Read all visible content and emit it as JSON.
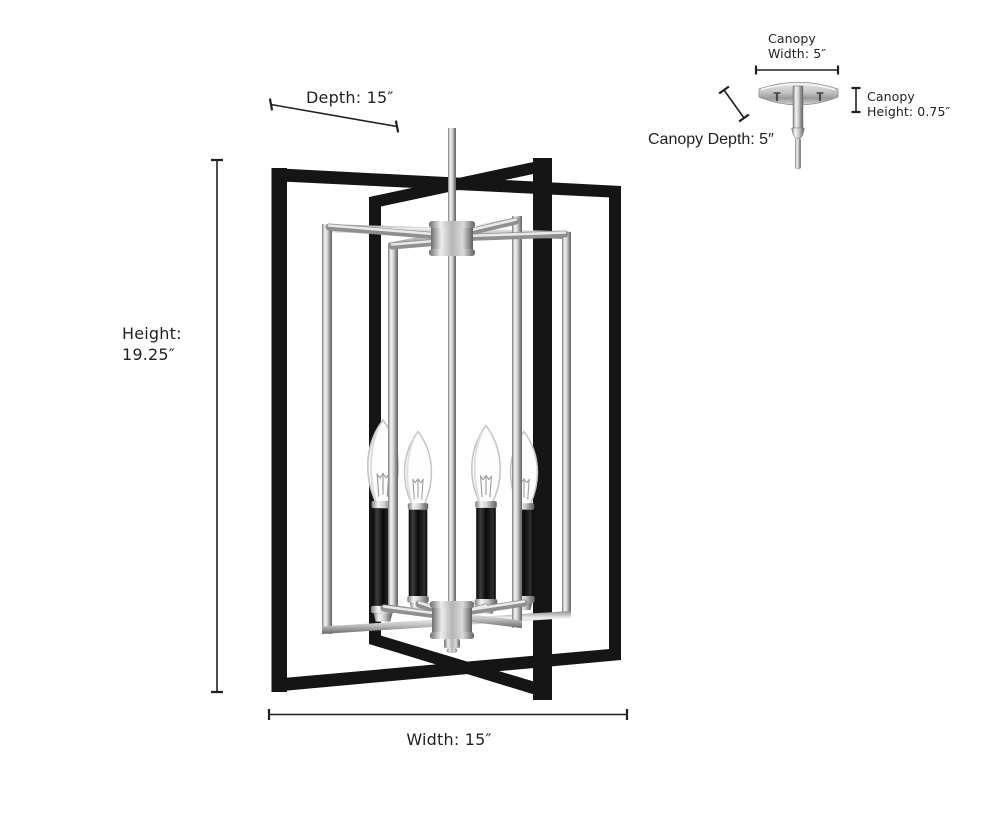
{
  "diagram": {
    "kind": "pendant-light-dimension-diagram",
    "bulb_count": 4,
    "labels": {
      "depth": "Depth: 15″",
      "height_line1": "Height:",
      "height_line2": "19.25″",
      "width": "Width: 15″",
      "canopy_width_line1": "Canopy",
      "canopy_width_line2": "Width: 5″",
      "canopy_height_line1": "Canopy",
      "canopy_height_line2": "Height: 0.75″",
      "canopy_depth": "Canopy Depth: 5″"
    },
    "dimensions_inches": {
      "depth": 15,
      "height": 19.25,
      "width": 15,
      "canopy_width": 5,
      "canopy_height": 0.75,
      "canopy_depth": 5
    },
    "colors": {
      "background": "#ffffff",
      "text": "#231f20",
      "frame_black": "#151515",
      "chrome_light": "#f2f2f2",
      "chrome_mid": "#b9b9b9",
      "chrome_dark": "#6e6e6e",
      "bulb_outline": "#c4c4c4"
    }
  }
}
